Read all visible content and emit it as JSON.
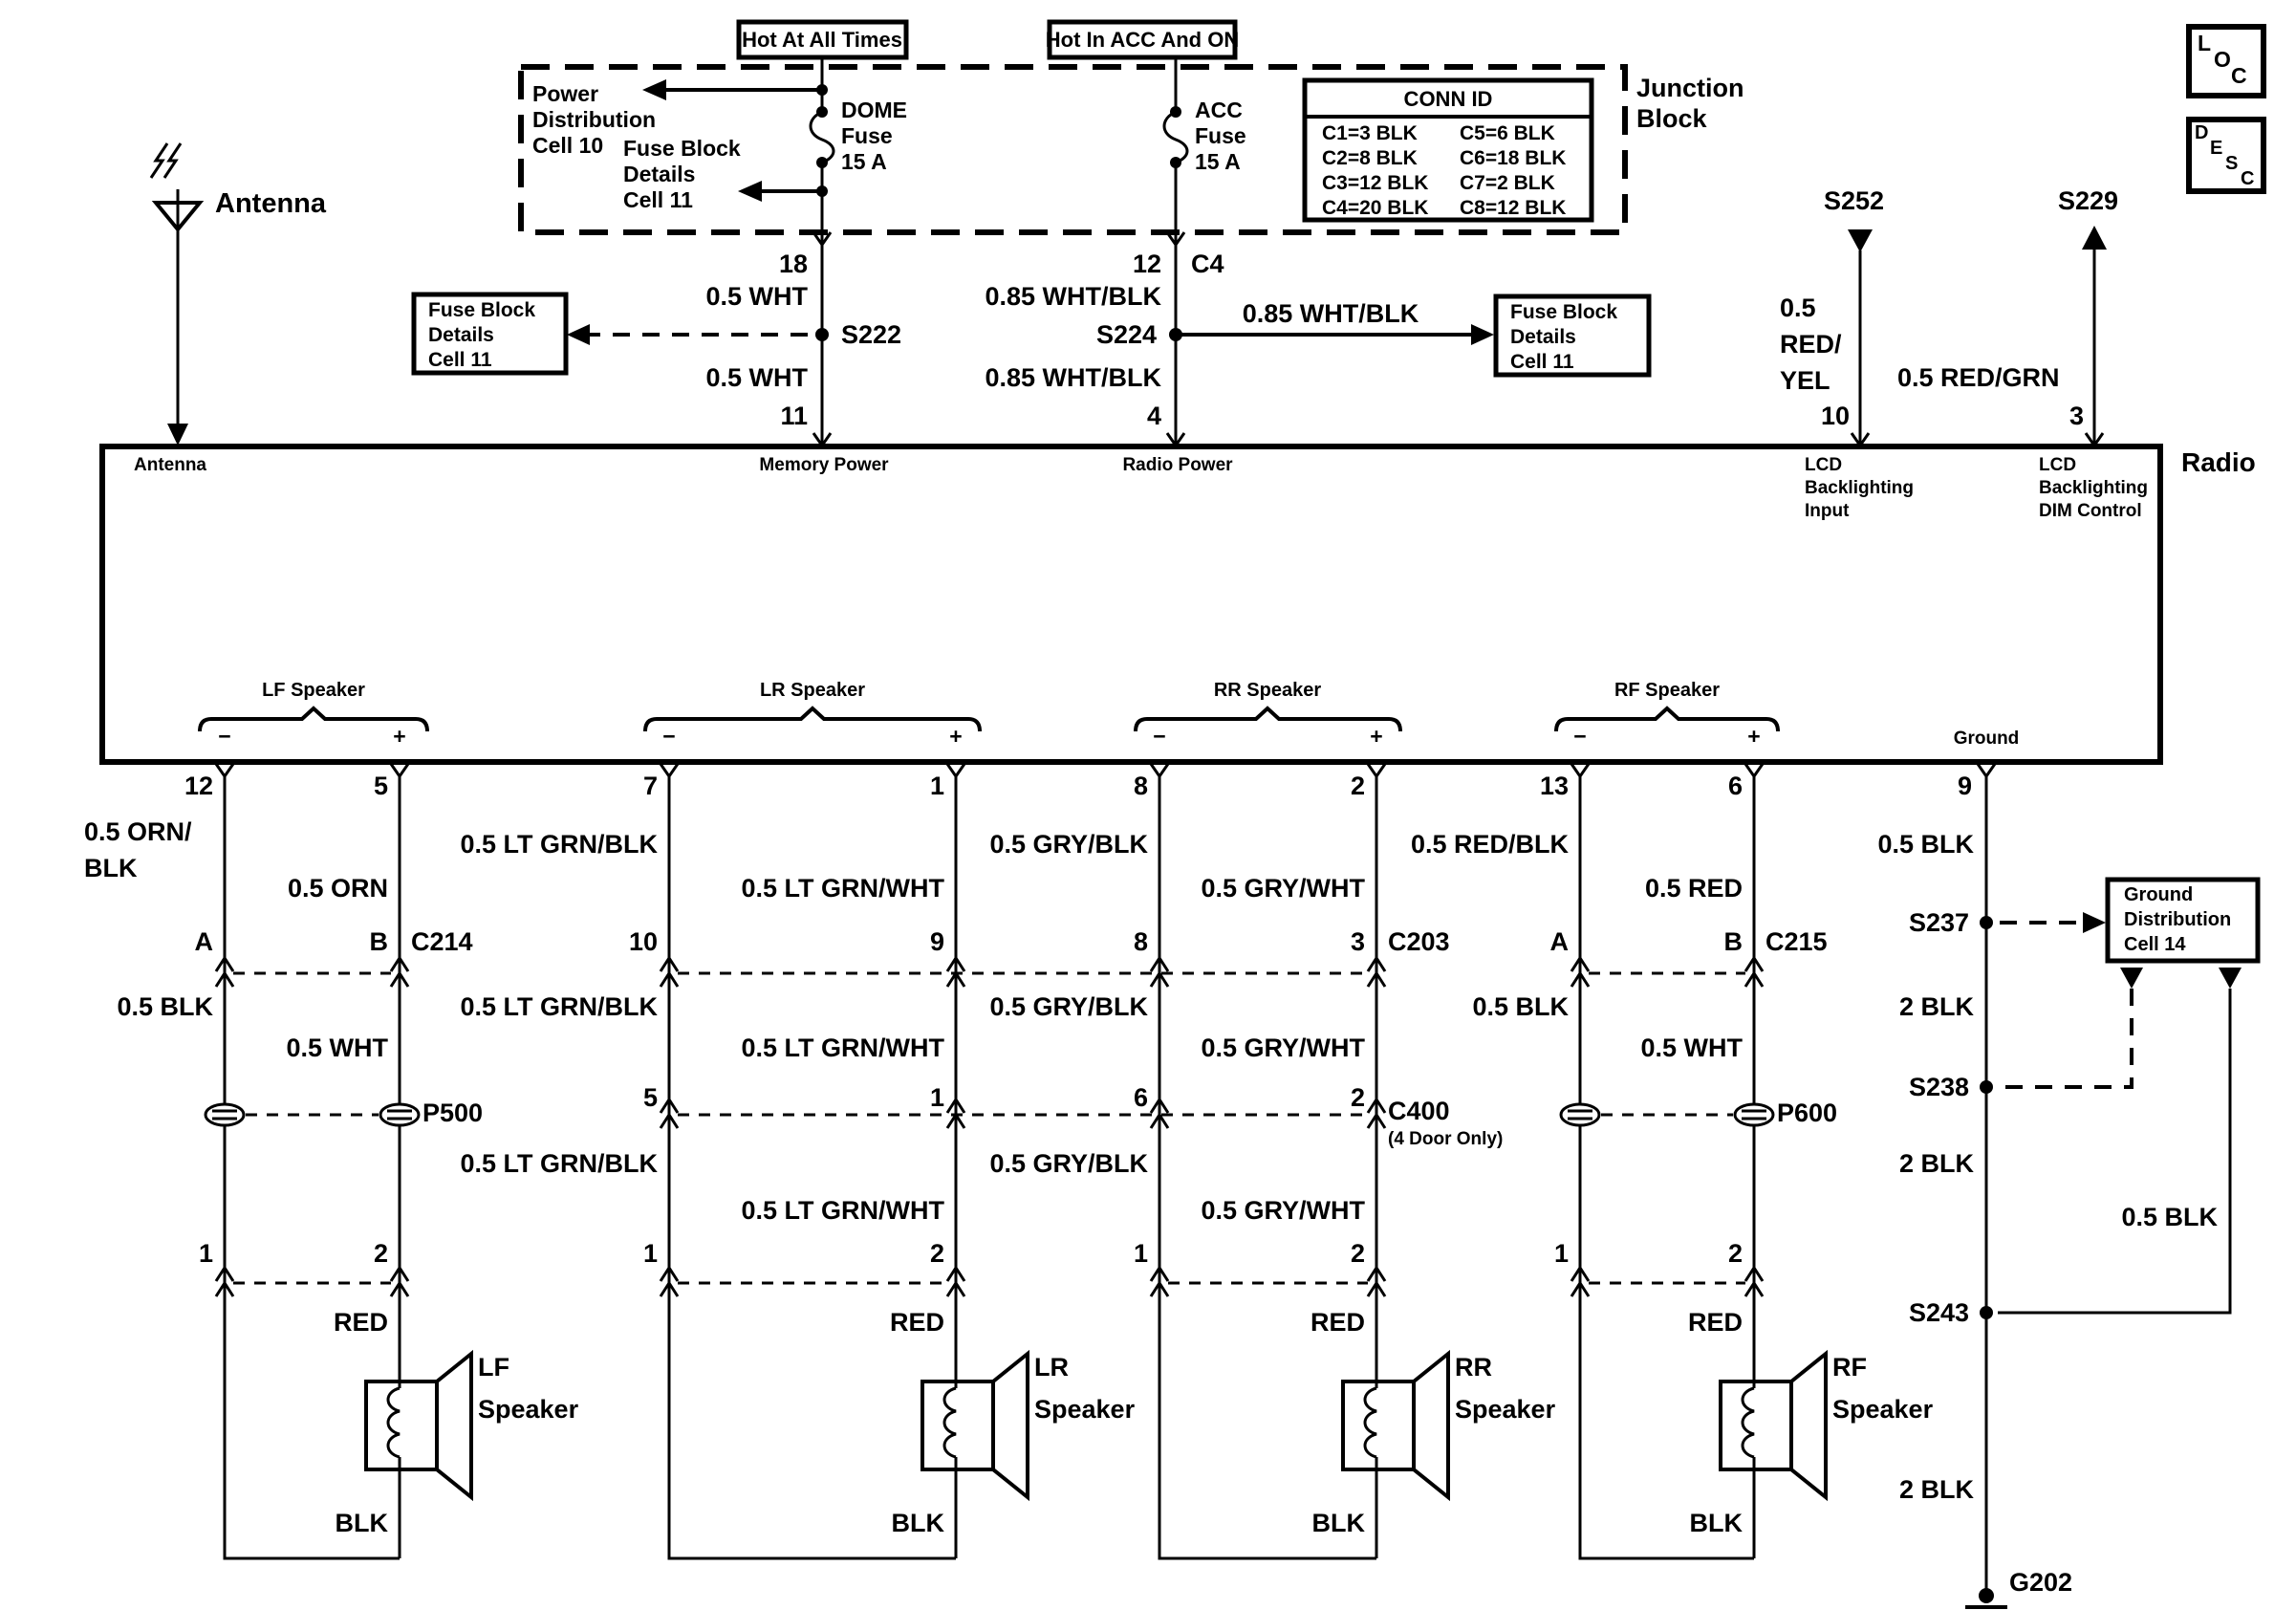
{
  "power": {
    "hot1": "Hot At All Times",
    "hot2": "Hot In ACC And ON",
    "junction": [
      "Junction",
      "Block"
    ],
    "pd": [
      "Power",
      "Distribution",
      "Cell 10"
    ],
    "fbd": [
      "Fuse Block",
      "Details",
      "Cell 11"
    ],
    "dome": [
      "DOME",
      "Fuse",
      "15 A"
    ],
    "acc": [
      "ACC",
      "Fuse",
      "15 A"
    ],
    "conn_id": {
      "title": "CONN ID",
      "rows": [
        [
          "C1=3 BLK",
          "C5=6 BLK"
        ],
        [
          "C2=8 BLK",
          "C6=18 BLK"
        ],
        [
          "C3=12 BLK",
          "C7=2 BLK"
        ],
        [
          "C4=20 BLK",
          "C8=12 BLK"
        ]
      ]
    }
  },
  "mem": {
    "pin_top": "18",
    "wire": "0.5 WHT",
    "splice": "S222",
    "wire2": "0.5 WHT",
    "pin_bot": "11"
  },
  "rp": {
    "pin_top": "12",
    "conn": "C4",
    "wire": "0.85 WHT/BLK",
    "splice": "S224",
    "branch": "0.85 WHT/BLK",
    "wire2": "0.85 WHT/BLK",
    "pin_bot": "4"
  },
  "bl_in": {
    "splice": "S252",
    "wire": [
      "0.5",
      "RED/",
      "YEL"
    ],
    "pin": "10",
    "func": [
      "LCD",
      "Backlighting",
      "Input"
    ]
  },
  "bl_dim": {
    "splice": "S229",
    "wire": "0.5 RED/GRN",
    "pin": "3",
    "func": [
      "LCD",
      "Backlighting",
      "DIM Control"
    ]
  },
  "radio": {
    "label": "Radio",
    "functions": {
      "memory": "Memory Power",
      "radio_power": "Radio Power",
      "ground": "Ground",
      "antenna": "Antenna"
    }
  },
  "antenna": {
    "label": "Antenna"
  },
  "corner": {
    "loc": [
      "L",
      "O",
      "C"
    ],
    "desc": [
      "D",
      "E",
      "S",
      "C"
    ]
  },
  "signs": {
    "minus": "−",
    "plus": "+"
  },
  "speakers": [
    {
      "bracket": "LF Speaker",
      "pin_neg": "12",
      "pin_pos": "5",
      "w1neg_a": "0.5 ORN/",
      "w1neg_b": "BLK",
      "w1pos": "0.5 ORN",
      "cneg": "A",
      "cpos": "B",
      "conn": "C214",
      "w2neg": "0.5 BLK",
      "w2pos": "0.5 WHT",
      "pass": "P500",
      "bneg": "1",
      "bpos": "2",
      "red": "RED",
      "blk": "BLK",
      "sym": [
        "LF",
        "Speaker"
      ]
    },
    {
      "bracket": "LR Speaker",
      "pin_neg": "7",
      "pin_pos": "1",
      "w1neg": "0.5 LT GRN/BLK",
      "w1pos": "0.5 LT GRN/WHT",
      "cneg": "10",
      "cpos": "9",
      "w2neg": "0.5 LT GRN/BLK",
      "w2pos": "0.5 LT GRN/WHT",
      "mneg": "5",
      "mpos": "1",
      "w3neg": "0.5 LT GRN/BLK",
      "w3pos": "0.5 LT GRN/WHT",
      "bneg": "1",
      "bpos": "2",
      "red": "RED",
      "blk": "BLK",
      "sym": [
        "LR",
        "Speaker"
      ]
    },
    {
      "bracket": "RR Speaker",
      "pin_neg": "8",
      "pin_pos": "2",
      "w1neg": "0.5 GRY/BLK",
      "w1pos": "0.5 GRY/WHT",
      "cneg": "8",
      "cpos": "3",
      "conn": "C203",
      "w2neg": "0.5 GRY/BLK",
      "w2pos": "0.5 GRY/WHT",
      "mneg": "6",
      "mpos": "2",
      "w3neg": "0.5 GRY/BLK",
      "w3pos": "0.5 GRY/WHT",
      "bneg": "1",
      "bpos": "2",
      "red": "RED",
      "blk": "BLK",
      "sym": [
        "RR",
        "Speaker"
      ]
    },
    {
      "bracket": "RF Speaker",
      "pin_neg": "13",
      "pin_pos": "6",
      "w1neg": "0.5 RED/BLK",
      "w1pos": "0.5 RED",
      "cneg": "A",
      "cpos": "B",
      "conn": "C215",
      "w2neg": "0.5 BLK",
      "w2pos": "0.5 WHT",
      "pass": "P600",
      "bneg": "1",
      "bpos": "2",
      "red": "RED",
      "blk": "BLK",
      "sym": [
        "RF",
        "Speaker"
      ]
    }
  ],
  "c400": {
    "label": "C400",
    "note": "(4 Door Only)"
  },
  "ground": {
    "pin": "9",
    "w1": "0.5 BLK",
    "s237": "S237",
    "box": [
      "Ground",
      "Distribution",
      "Cell 14"
    ],
    "w2": "2 BLK",
    "s238": "S238",
    "w3": "2 BLK",
    "right_wire": "0.5 BLK",
    "s243": "S243",
    "w4": "2 BLK",
    "g202": "G202"
  }
}
